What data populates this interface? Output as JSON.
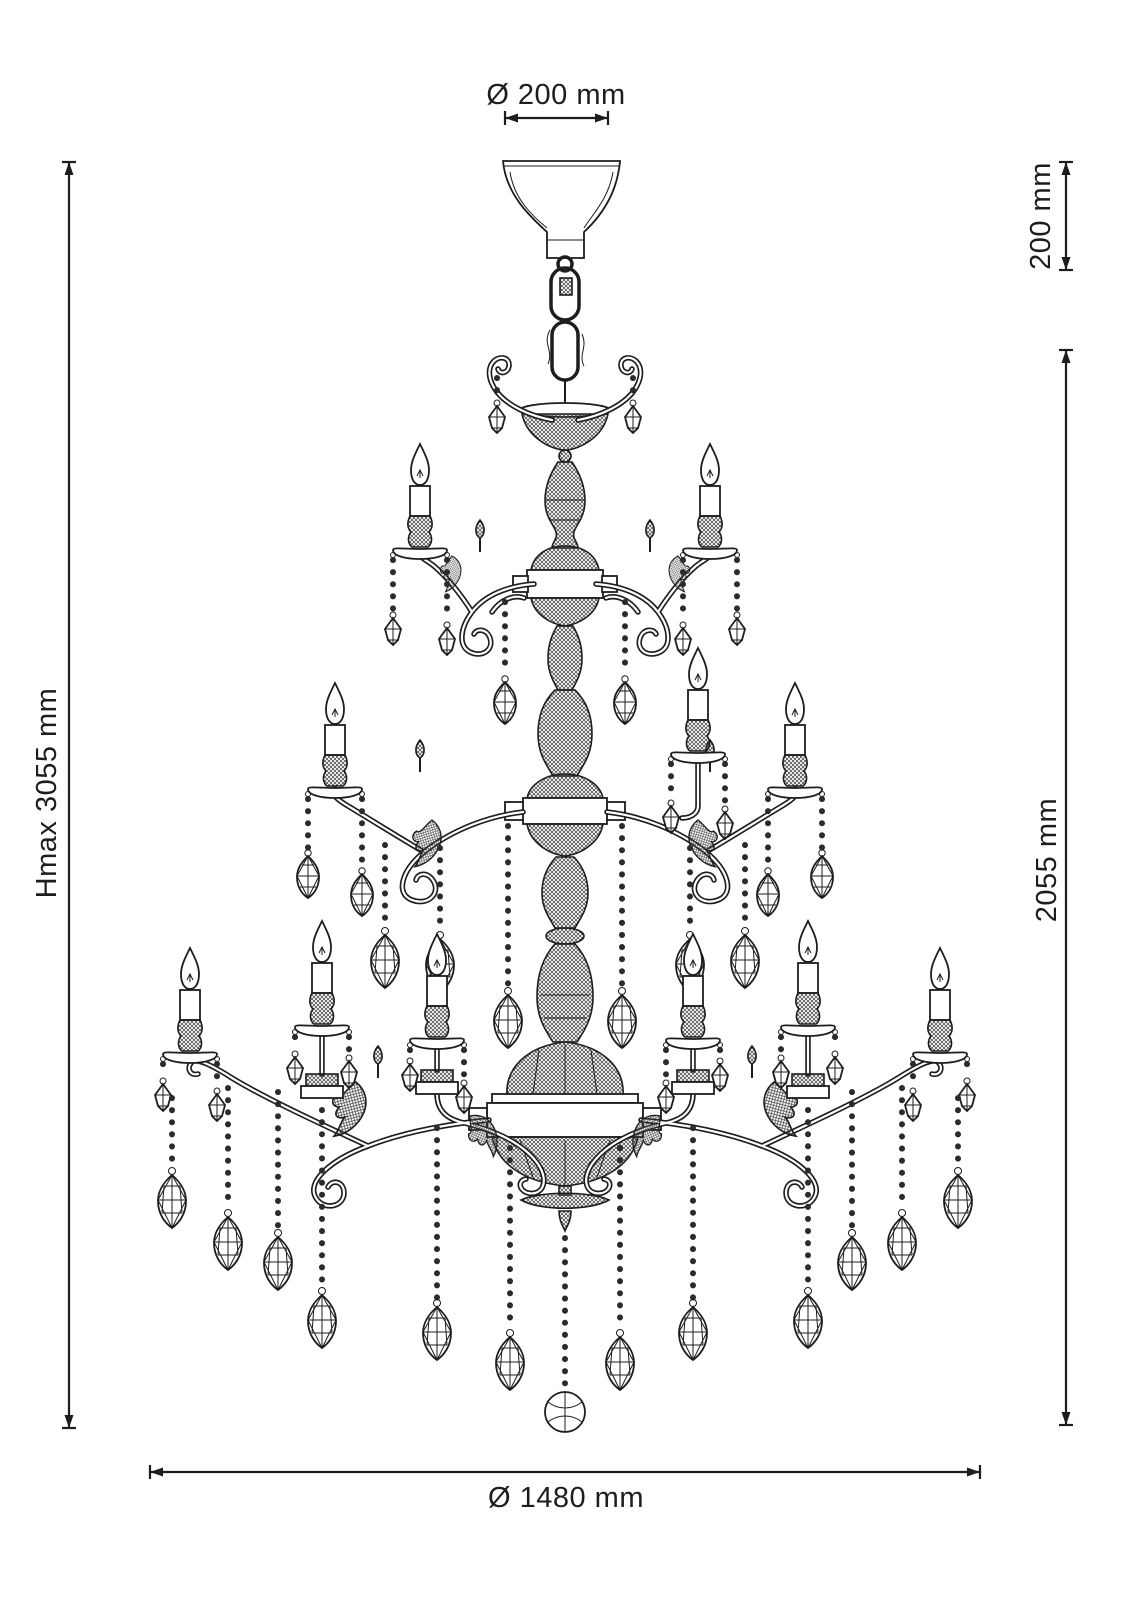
{
  "figure": {
    "type": "technical-line-drawing",
    "subject": "three-tier crystal chandelier with candle lights, bead chains and drop pendants, hung from a ceiling canopy"
  },
  "dimensions": {
    "canopy_diameter": "Ø 200 mm",
    "canopy_height": "200 mm",
    "max_height": "Hmax 3055 mm",
    "body_height": "2055 mm",
    "body_diameter": "Ø 1480 mm"
  },
  "style": {
    "line_color": "#1d1d1b",
    "background_color": "#ffffff"
  }
}
